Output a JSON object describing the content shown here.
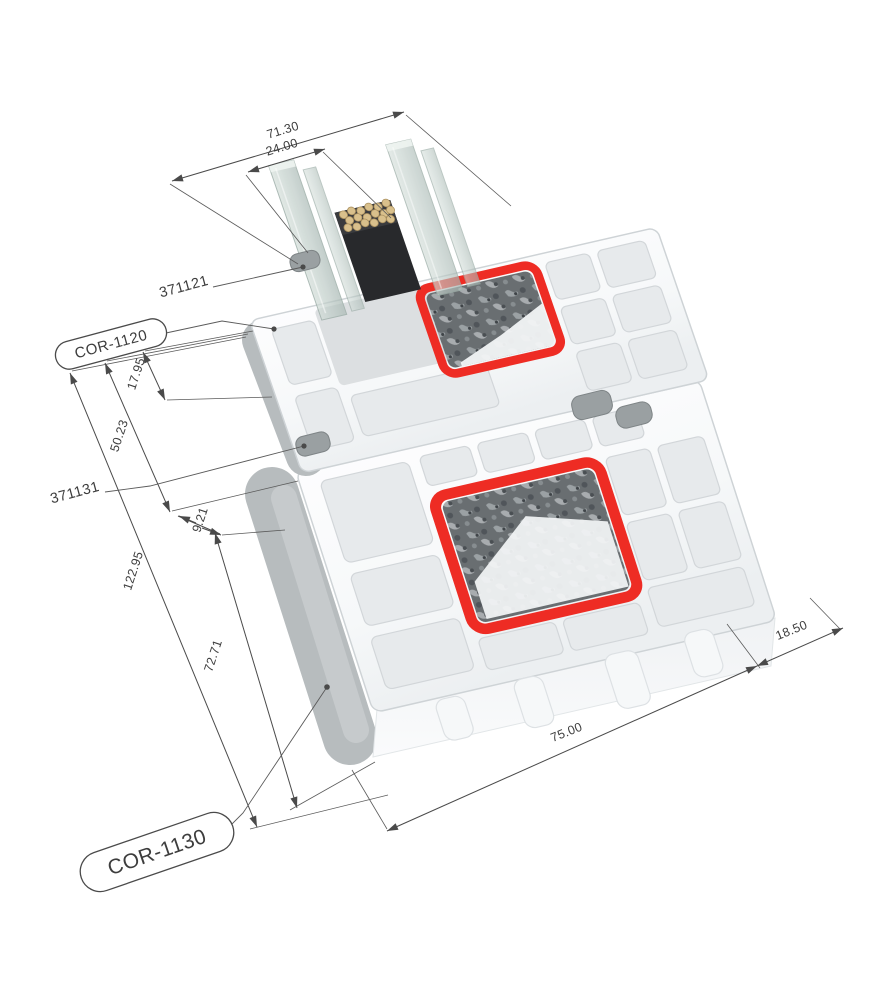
{
  "figure": {
    "description": "Isometric cutaway render of two PVC window profiles (sash and frame) with insulated glazing unit, steel reinforcement chambers highlighted in red, and CAD dimension annotations",
    "background": "#ffffff"
  },
  "dims": {
    "d71": "71.30",
    "d24": "24.00",
    "d17": "17.95",
    "d50": "50.23",
    "d9": "9.21",
    "d122": "122.95",
    "d72": "72.71",
    "d75": "75.00",
    "d18": "18.50"
  },
  "parts": {
    "upper": "371121",
    "lower": "371131"
  },
  "callouts": {
    "upper": "COR-1120",
    "lower": "COR-1130"
  },
  "colors": {
    "highlight_red": "#ee2c24",
    "steel_speckle_base": "#696e71",
    "glass": "#c5d2ce",
    "spacer_black": "#26272a",
    "desiccant_beads": "#d9c08c",
    "profile_white": "#f8fafb",
    "chamber_shadow": "#e7eaec",
    "outer_wall_gray": "#b7bcbe",
    "gasket_gray": "#9aa0a2",
    "dimension_line": "#4a4a4a"
  }
}
